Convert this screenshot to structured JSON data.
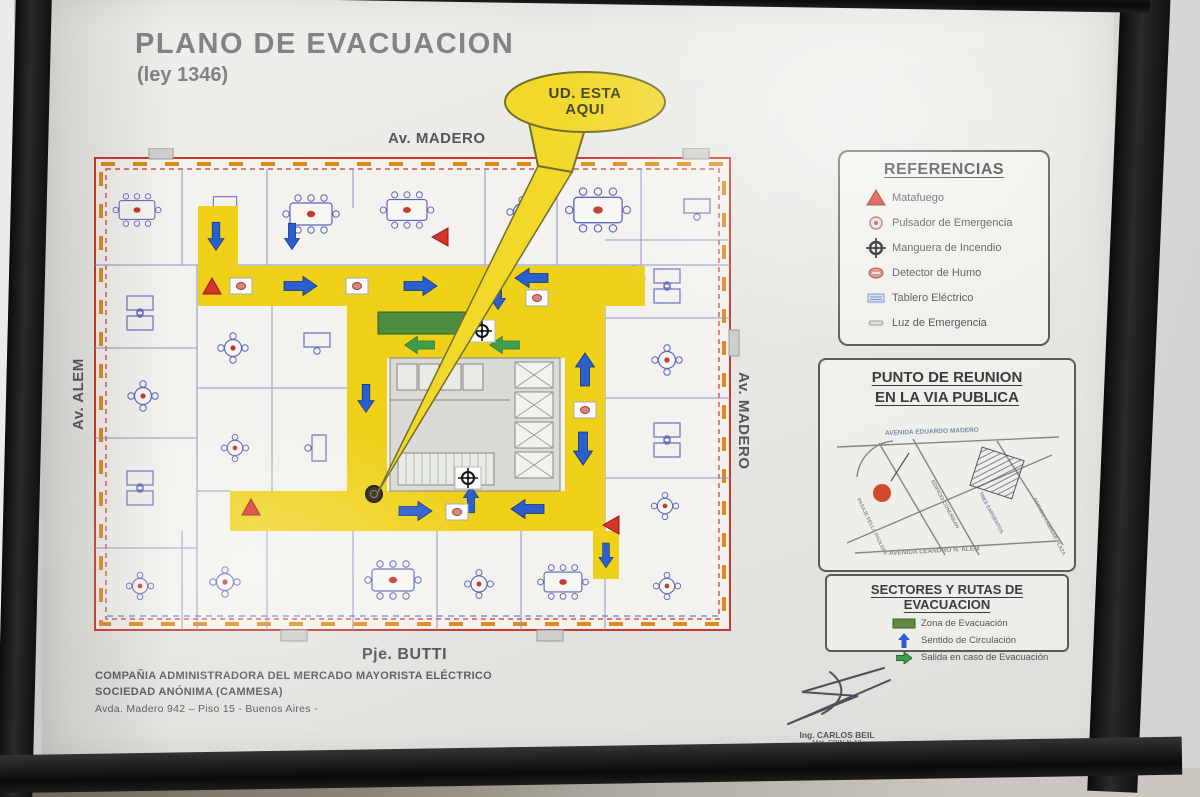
{
  "poster": {
    "title": "PLANO DE EVACUACION",
    "law": "(ley 1346)",
    "sheet_label": "Plano 1",
    "you_are_here": {
      "line1": "UD. ESTA",
      "line2": "AQUI"
    }
  },
  "streets": {
    "top": "Av. MADERO",
    "left": "Av. ALEM",
    "right": "Av. MADERO",
    "bottom": "Pje. BUTTI"
  },
  "referencias": {
    "title": "REFERENCIAS",
    "items": [
      {
        "icon": "extinguisher-triangle-icon",
        "label": "Matafuego"
      },
      {
        "icon": "emergency-pushbutton-icon",
        "label": "Pulsador de Emergencia"
      },
      {
        "icon": "fire-hose-icon",
        "label": "Manguera de Incendio"
      },
      {
        "icon": "smoke-detector-icon",
        "label": "Detector de Humo"
      },
      {
        "icon": "electrical-panel-icon",
        "label": "Tablero Eléctrico"
      },
      {
        "icon": "emergency-light-icon",
        "label": "Luz de Emergencia"
      }
    ]
  },
  "meeting_point": {
    "title_line1": "PUNTO DE REUNION",
    "title_line2": "EN LA VIA PUBLICA",
    "map": {
      "top_street": "AVENIDA EDUARDO MADERO",
      "bottom_street": "AVENIDA LEANDRO N. ALEM",
      "left_street": "PASAJE DELLA PAOLERA",
      "diagonal_street": "TRES SARGENTOS",
      "building_left": "EDIFICIO CONURBAN",
      "building_right": "EDIFICIO LAMINAR PLAZA"
    }
  },
  "sectores": {
    "title": "SECTORES Y RUTAS DE EVACUACION",
    "items": [
      {
        "icon": "evacuation-zone-swatch",
        "label": "Zona de Evacuación"
      },
      {
        "icon": "circulation-direction-arrow",
        "label": "Sentido de Circulación"
      },
      {
        "icon": "evacuation-exit-arrow",
        "label": "Salida en caso de Evacuación"
      }
    ]
  },
  "footer": {
    "company_line1": "COMPAÑIA ADMINISTRADORA DEL MERCADO MAYORISTA ELÉCTRICO",
    "company_line2": "SOCIEDAD ANÓNIMA (CAMMESA)",
    "company_line3": "Avda. Madero 942 – Piso 15 - Buenos Aires -",
    "signer_name": "Ing. CARLOS BEIL",
    "signer_reg1": "Mat. CPIN N-13",
    "signer_reg2": "M.P. 7994-2767"
  },
  "palette": {
    "route_yellow": "#efd11a",
    "circulation_blue": "#2a5fd0",
    "exit_green": "#3f9e4d",
    "extinguisher_red": "#d5342a",
    "zone_green": "#4e8c3f"
  }
}
